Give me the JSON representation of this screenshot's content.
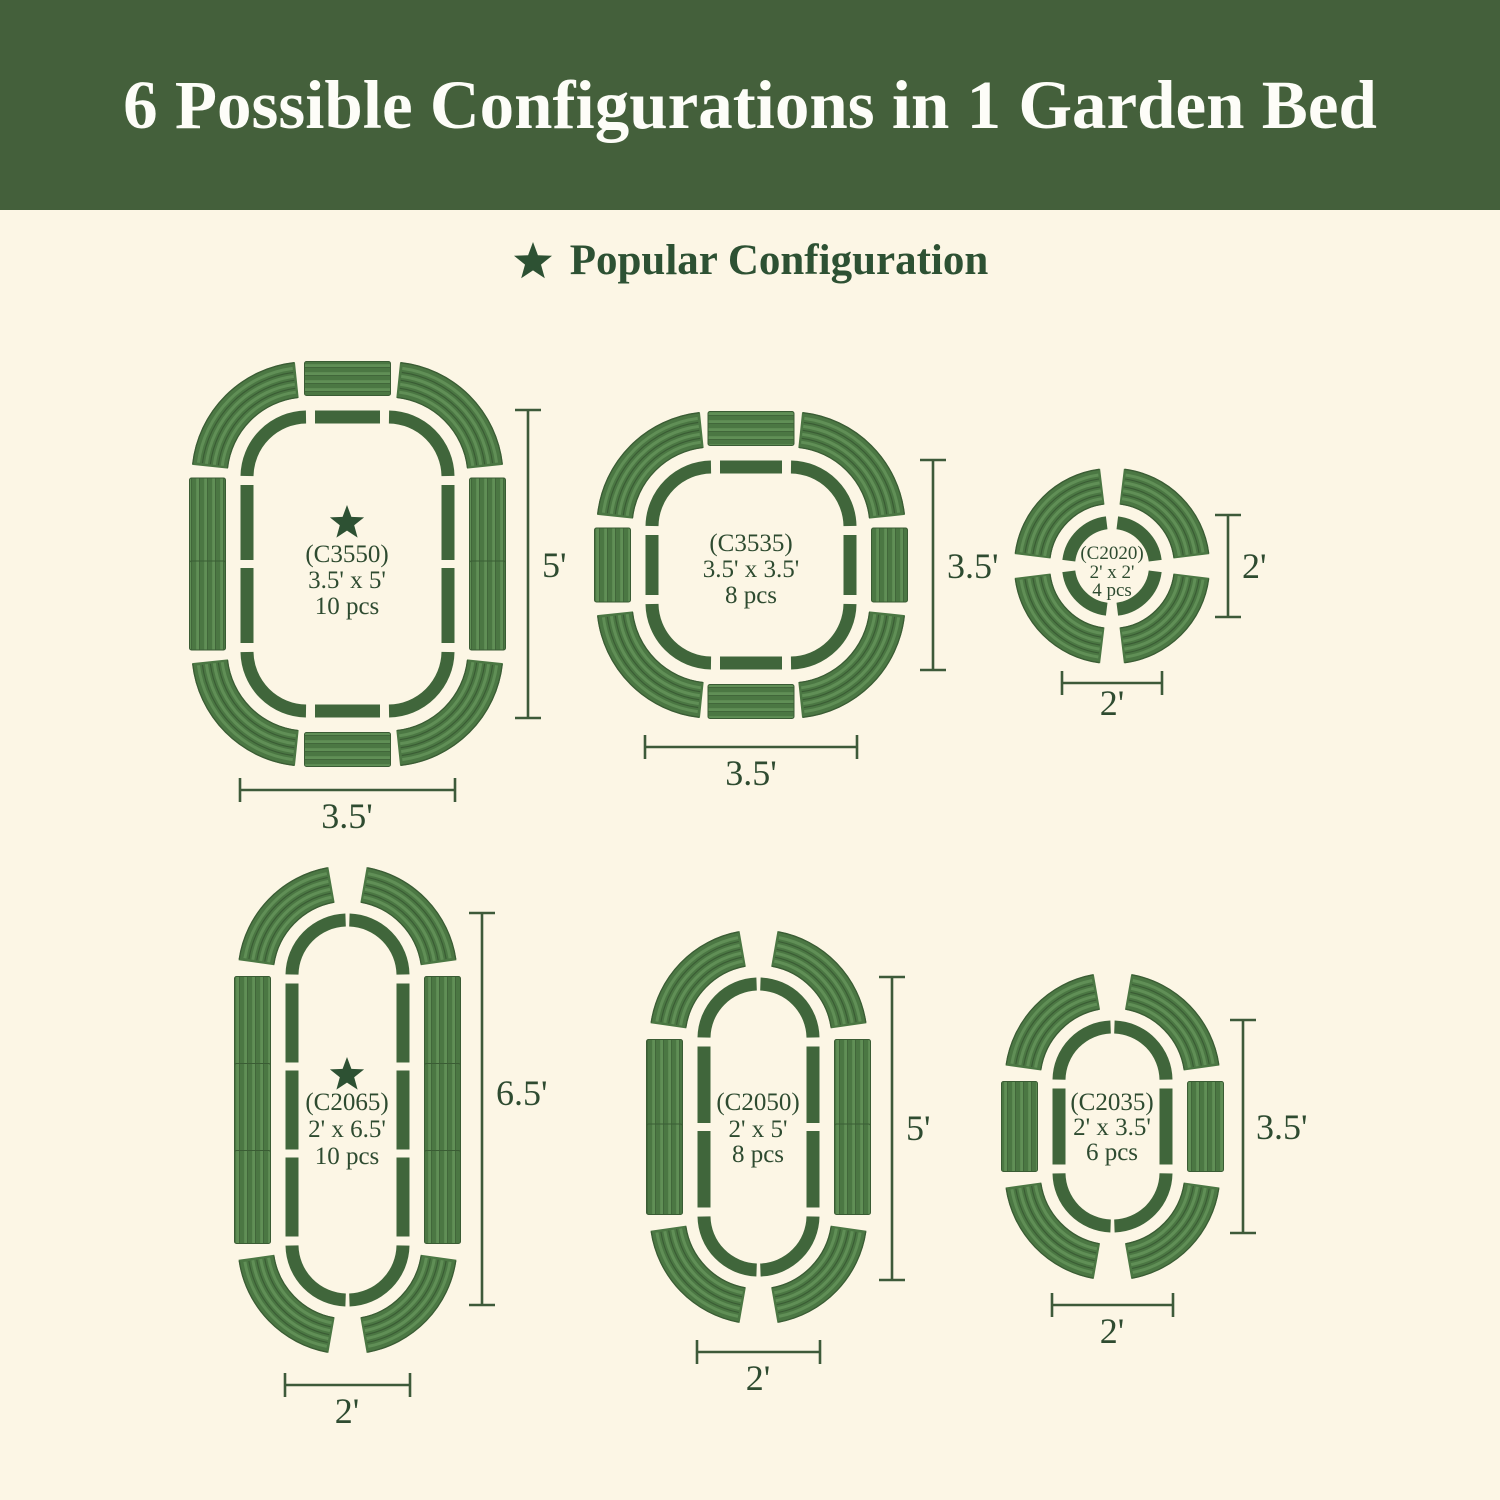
{
  "banner": {
    "title": "6 Possible Configurations in 1 Garden Bed",
    "bg_color": "#44603b",
    "text_color": "#fdfdf8"
  },
  "subheading": {
    "star_icon": "star",
    "label": "Popular Configuration",
    "color": "#2d5133"
  },
  "colors": {
    "page_bg": "#fcf6e5",
    "outline_green": "#40663b",
    "panel_base": "#4b7743",
    "panel_stripe_light": "#608f56",
    "panel_stripe_dark": "#3a5c34",
    "dimension_line": "#3d5a39",
    "label_text": "#2e4b30"
  },
  "configurations": [
    {
      "id": "C3550",
      "model": "(C3550)",
      "size": "3.5' x 5'",
      "pieces": "10 pcs",
      "popular": true,
      "height_label": "5'",
      "width_label": "3.5'"
    },
    {
      "id": "C3535",
      "model": "(C3535)",
      "size": "3.5' x 3.5'",
      "pieces": "8 pcs",
      "popular": false,
      "height_label": "3.5'",
      "width_label": "3.5'"
    },
    {
      "id": "C2020",
      "model": "(C2020)",
      "size": "2' x 2'",
      "pieces": "4 pcs",
      "popular": false,
      "height_label": "2'",
      "width_label": "2'"
    },
    {
      "id": "C2065",
      "model": "(C2065)",
      "size": "2' x 6.5'",
      "pieces": "10 pcs",
      "popular": true,
      "height_label": "6.5'",
      "width_label": "2'"
    },
    {
      "id": "C2050",
      "model": "(C2050)",
      "size": "2' x 5'",
      "pieces": "8 pcs",
      "popular": false,
      "height_label": "5'",
      "width_label": "2'"
    },
    {
      "id": "C2035",
      "model": "(C2035)",
      "size": "2' x 3.5'",
      "pieces": "6 pcs",
      "popular": false,
      "height_label": "3.5'",
      "width_label": "2'"
    }
  ]
}
